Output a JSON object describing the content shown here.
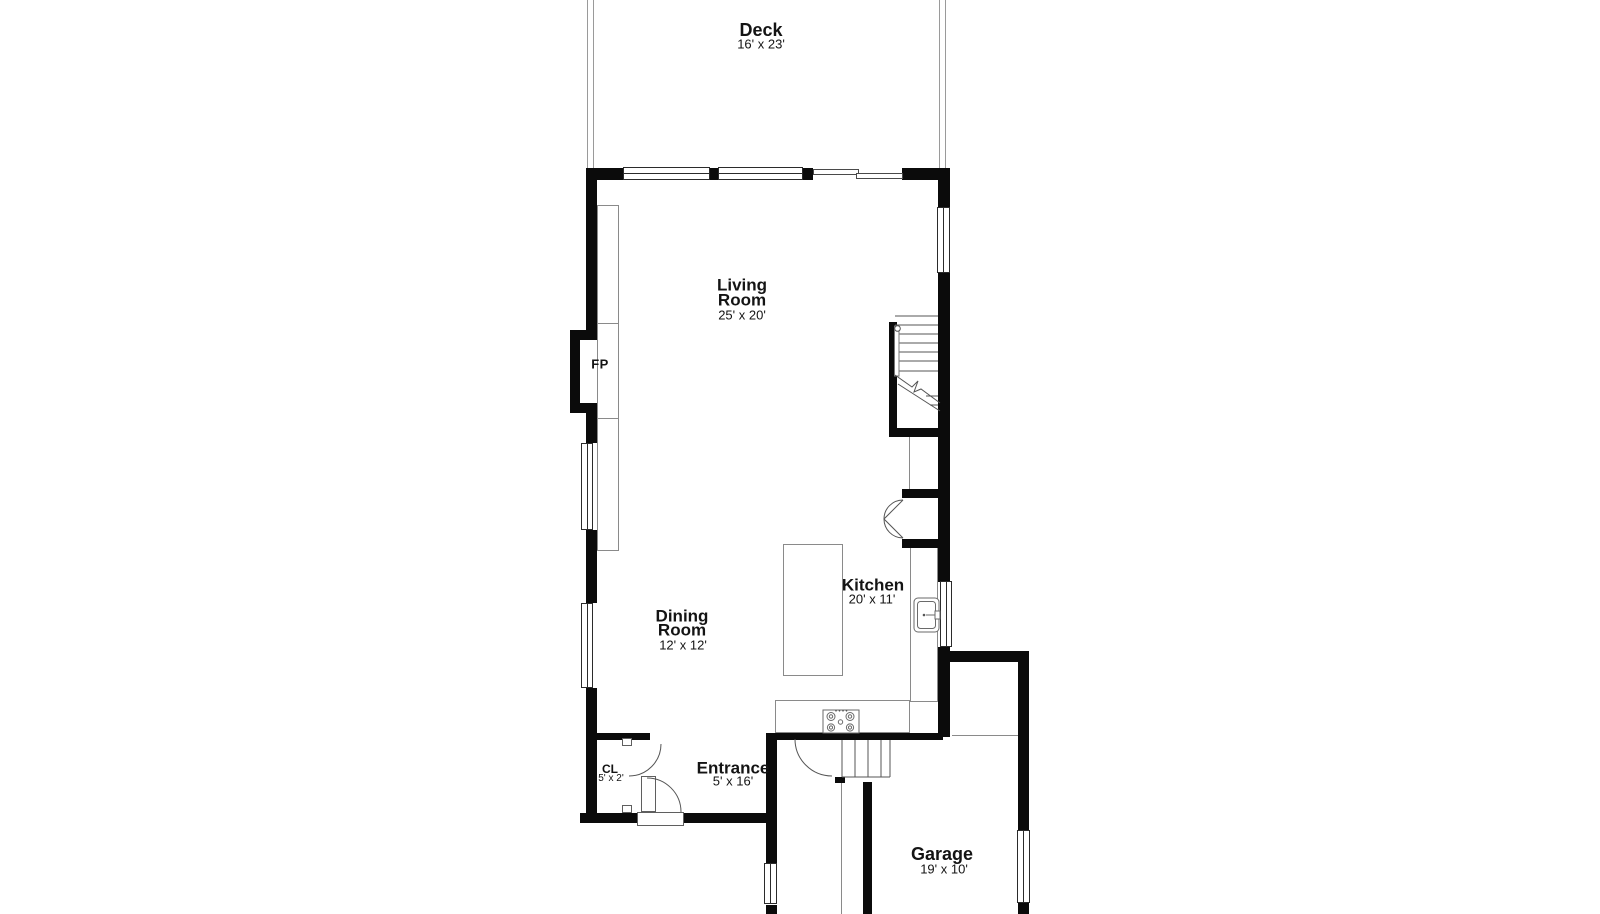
{
  "plan_type": "floor-plan",
  "colors": {
    "background": "#ffffff",
    "walls": "#0b0b0b",
    "thin_lines": "#8a8a8a",
    "text": "#141414"
  },
  "rooms": {
    "deck": {
      "name": "Deck",
      "dims": "16' x 23'"
    },
    "living_room": {
      "line1": "Living",
      "line2": "Room",
      "dims": "25' x 20'"
    },
    "kitchen": {
      "name": "Kitchen",
      "dims": "20' x 11'"
    },
    "dining_room": {
      "line1": "Dining",
      "line2": "Room",
      "dims": "12' x 12'"
    },
    "entrance": {
      "name": "Entrance",
      "dims": "5' x 16'"
    },
    "closet": {
      "name": "CL",
      "dims": "5' x 2'"
    },
    "garage": {
      "name": "Garage",
      "dims": "19' x 10'"
    },
    "fireplace": {
      "name": "FP"
    }
  },
  "features": [
    "fireplace",
    "built-in-shelves",
    "kitchen-island",
    "kitchen-counter",
    "sink",
    "range",
    "pantry-double-doors",
    "main-stairs",
    "basement-stairs",
    "sliding-glass-door",
    "front-door",
    "closet-door",
    "windows",
    "deck-rails"
  ]
}
